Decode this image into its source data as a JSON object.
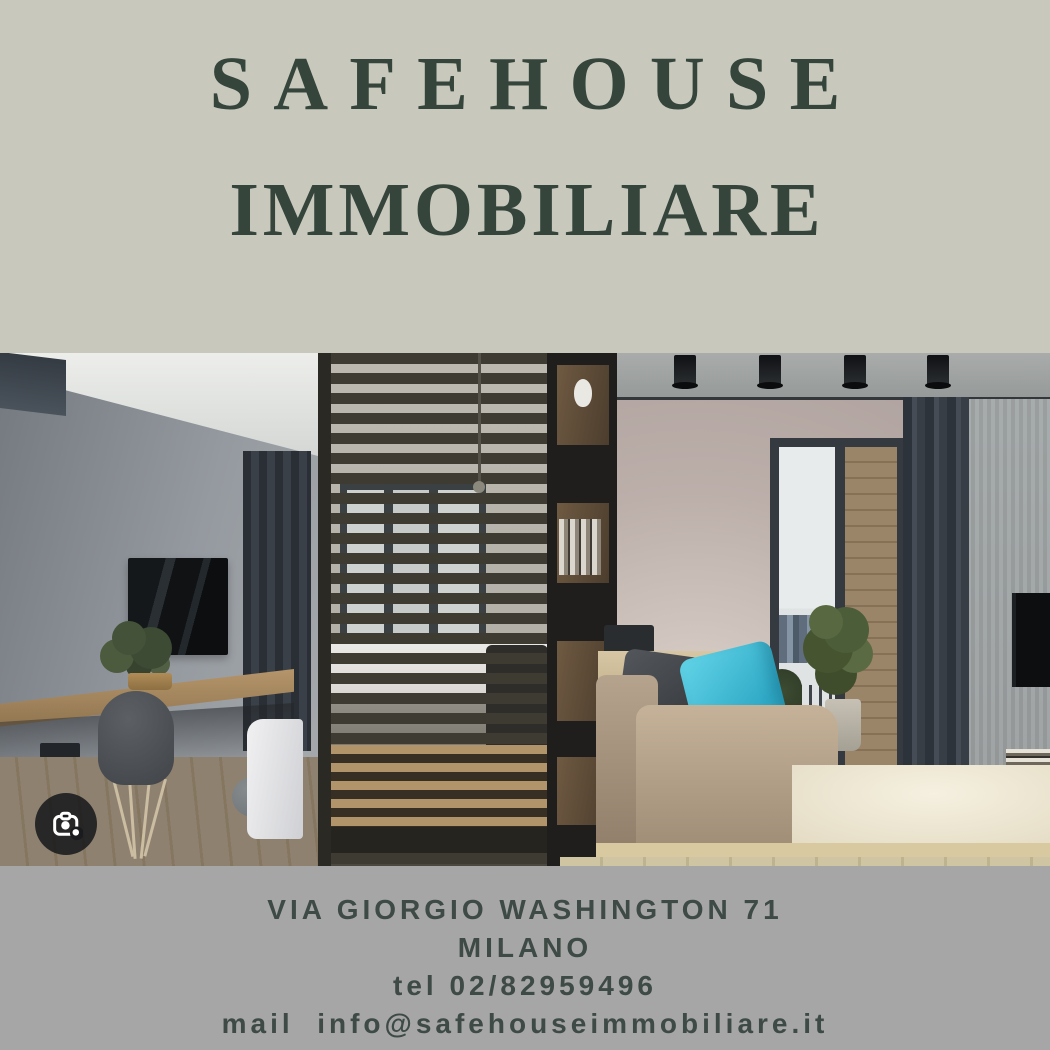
{
  "brand": {
    "title_line1": "SAFEHOUSE",
    "title_line2": "IMMOBILIARE"
  },
  "contact": {
    "address": "VIA GIORGIO WASHINGTON 71",
    "city": "MILANO",
    "phone": "tel 02/82959496",
    "email_line": "mail  info@safehouseimmobiliare.it"
  },
  "photo": {
    "description": "modern studio apartment interior: gray wall with TV and floating wooden desk, wooden slat room divider with bed behind, dark shelving unit, beige lounge area with daybed, cyan pillow, balcony glass door with brick wall and city view, dark curtains, ceiling spotlights"
  },
  "icons": {
    "lens": "google-lens-camera-icon"
  },
  "colors": {
    "top_background": "#c8c9bc",
    "title_text": "#35453c",
    "footer_background": "#a6a6a6",
    "footer_text": "#3e4a45",
    "accent_pillow": "#3fc1dd",
    "lens_circle": "#1a1b1e"
  }
}
